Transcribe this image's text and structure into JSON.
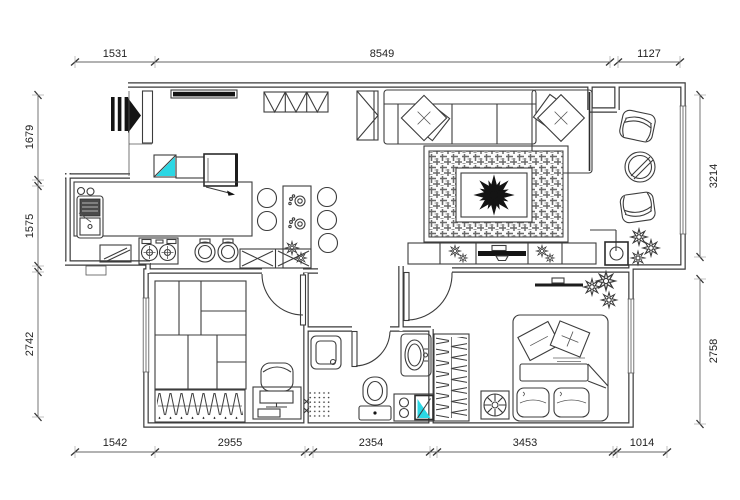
{
  "canvas": {
    "width": 740,
    "height": 500,
    "background": "#ffffff"
  },
  "colors": {
    "wall": "#3a3a3a",
    "line": "#3c3c3c",
    "accent_cyan": "#2bd7e4",
    "dim_text": "#222222"
  },
  "dimensions": {
    "top": [
      "1531",
      "8549",
      "1127"
    ],
    "bottom": [
      "1542",
      "2955",
      "2354",
      "3453",
      "1014"
    ],
    "left": [
      "1679",
      "1575",
      "2742"
    ],
    "right": [
      "3214",
      "2758"
    ]
  },
  "icons": [
    "entry-arrow-icon",
    "entry-door",
    "coat-rack",
    "shoe-cabinet",
    "storage-bench",
    "v-cabinet",
    "tall-cabinet",
    "kitchen-sink",
    "soap-cups",
    "cutting-board",
    "gas-stove",
    "cook-pots",
    "cross-cabinet",
    "bar-counter",
    "bar-stool",
    "bar-cup",
    "flower-pot",
    "sofa",
    "sofa-pillow",
    "chaise",
    "area-rug",
    "coffee-table",
    "plant-scribble",
    "tv-console",
    "tv",
    "balcony-armchair",
    "balcony-round-table",
    "corner-table",
    "window",
    "tatami-cabinet",
    "wardrobe-hangers",
    "desk",
    "desk-chair",
    "interior-door",
    "shower-box",
    "floor-drain",
    "toilet",
    "washbasin",
    "laundry-sink",
    "washing-machine",
    "wall-tv",
    "double-bed",
    "bed-pillow",
    "electric-fan",
    "dimension-line"
  ]
}
